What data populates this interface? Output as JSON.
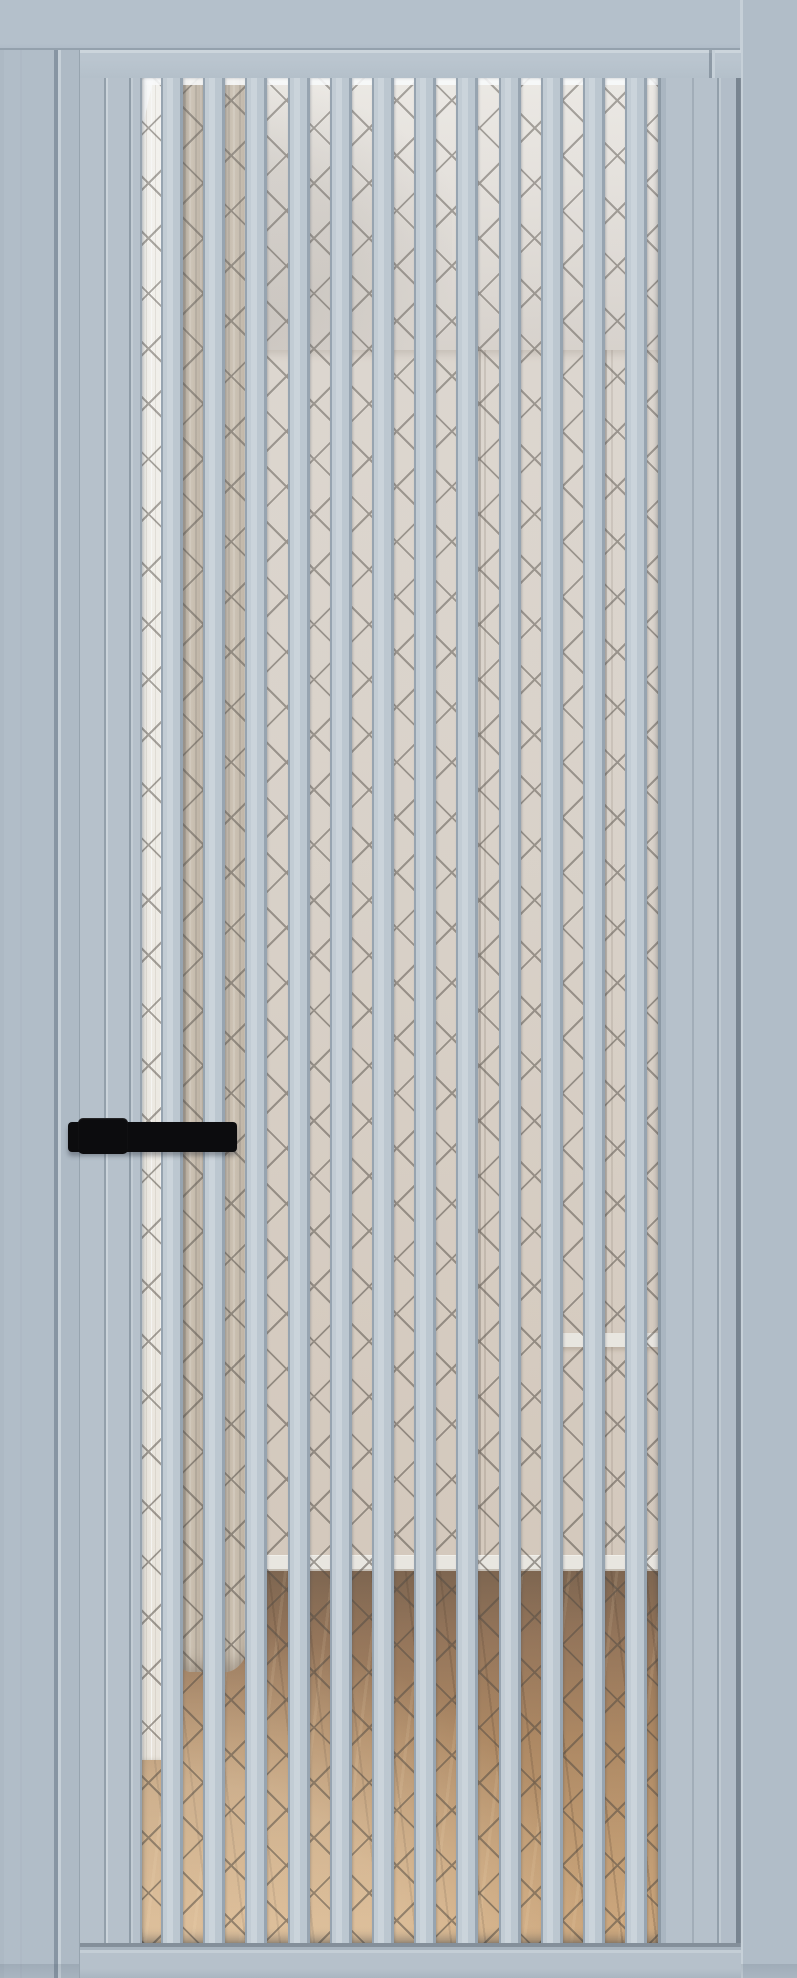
{
  "image": {
    "description": "Product render of an interior glass door: light grey-blue aluminium frame and twelve vertical lamella slats over glass with a dark diamond cross-hatch pattern; black lever handle on the left stile; behind the glass a room interior with a white sheer and taupe curtain on the left, cream wall and ceiling, white baseboard and a wooden floor at the bottom.",
    "width_px": 797,
    "height_px": 1978
  },
  "palette": {
    "frame": "#b1bdc8",
    "frame_jamb": "#aebac5",
    "frame_shadow": "#8795a3",
    "door": "#b6c1cb",
    "slat_hi": "#cbd4db",
    "slat_mid": "#bcc7d0",
    "slat_sh": "#97a4b0",
    "ridge": "#c6d0d8",
    "handle": "#0c0c0e",
    "ceiling": "#e7e1da",
    "ceiling_lo": "#d5cdc5",
    "wall": "#d8cec3",
    "wall_lo": "#cfc1b2",
    "baseboard": "#eae6df",
    "floor_dk": "#70543b",
    "floor_md": "#a67c52",
    "floor_lt": "#cda374",
    "curtain": "#b2a492",
    "curtain_sh": "#8f8170",
    "curtain_hi": "#c9bcaa",
    "sheer": "#f2eee6",
    "lattice": "#3f372e"
  },
  "door": {
    "leaf": {
      "x": 79,
      "y": 50,
      "w": 661,
      "h": 1928
    },
    "glass": {
      "x": 141,
      "y": 78,
      "w": 516,
      "h": 1865
    },
    "slats": {
      "count": 12,
      "first_offset": 19,
      "pitch": 42.2,
      "width": 22
    },
    "lattice": {
      "spacing_px": 39,
      "thickness_px": 2
    }
  },
  "handle": {
    "lever": {
      "x": 68,
      "y": 1122,
      "w": 169,
      "h": 30
    },
    "plate": {
      "x": 78,
      "y": 1118,
      "w": 50,
      "h": 36
    }
  },
  "room": {
    "ceiling_line_y": 350,
    "baseboard_y": 1555,
    "floor_top_y": 1571,
    "wall_corner_lines_x": [
      478,
      604
    ],
    "ledge": {
      "x": 560,
      "y": 1333
    },
    "sheer_bottom_y": 1760,
    "curtain_bottom_y": 1672
  }
}
